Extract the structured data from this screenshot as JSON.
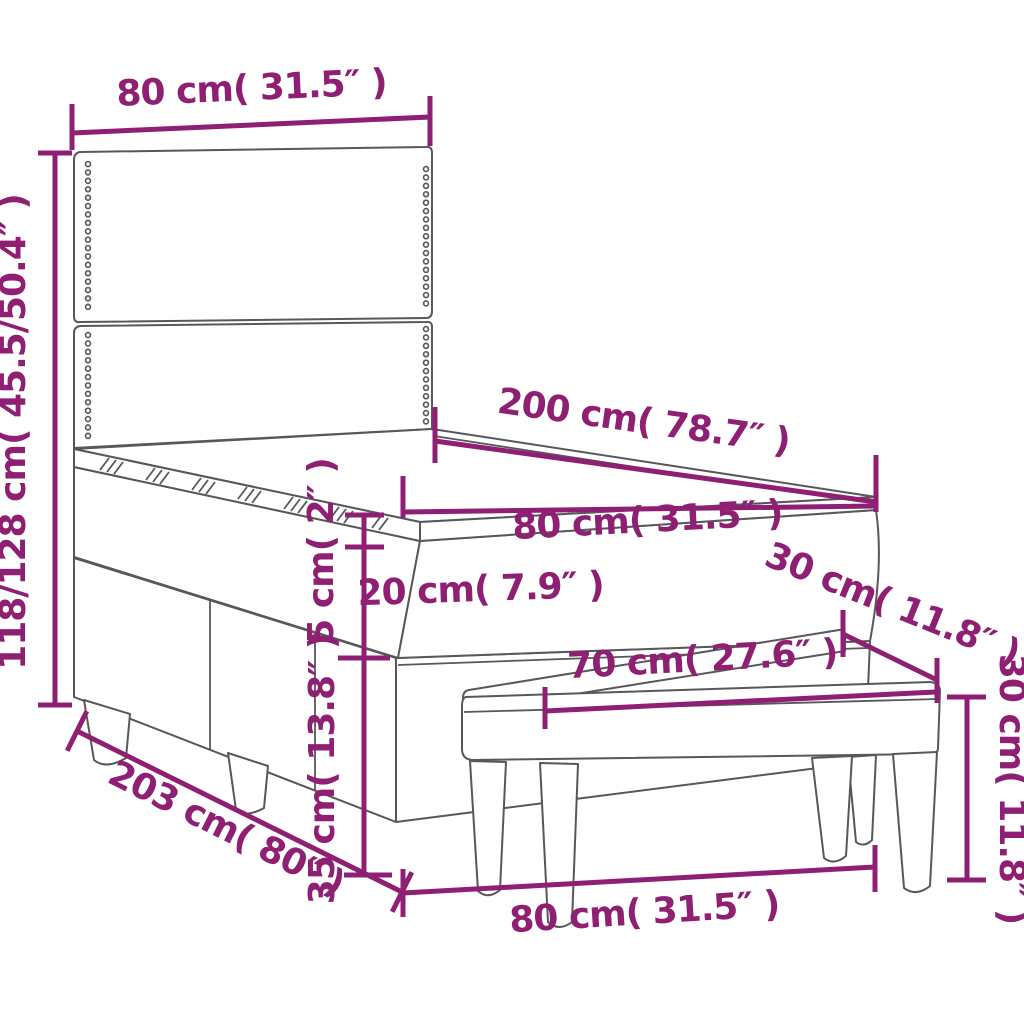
{
  "colors": {
    "dimension": "#8e1f72",
    "outline": "#58585b"
  },
  "dimensions": {
    "headboard_width": "80 cm( 31.5″ )",
    "headboard_height": "118/128 cm( 45.5/50.4″ )",
    "bed_length": "200 cm( 78.7″ )",
    "bed_width": "80 cm( 31.5″ )",
    "topper_height": "5 cm( 2″ )",
    "mattress_height": "20 cm( 7.9″ )",
    "base_height": "35 cm( 13.8″ )",
    "total_length": "203 cm( 80″ )",
    "bench_seat_length": "70 cm( 27.6″ )",
    "bench_depth": "30 cm( 11.8″ )",
    "bench_height": "30 cm( 11.8″ )",
    "bench_length": "80 cm( 31.5″ )"
  }
}
